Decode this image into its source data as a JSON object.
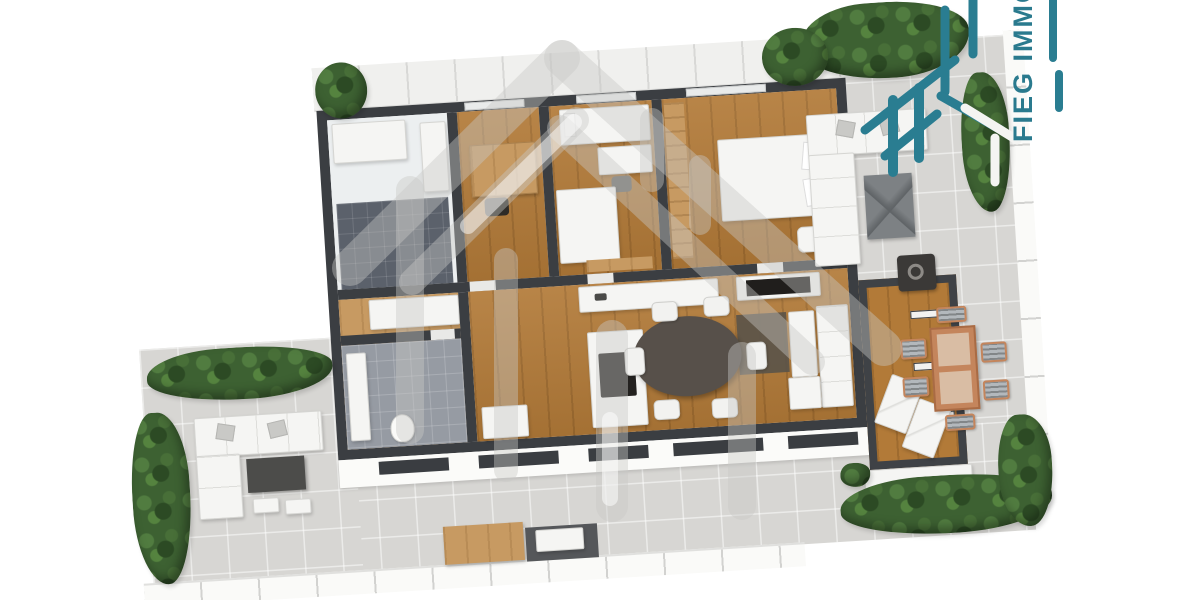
{
  "scene": {
    "type": "3d-rendered-floor-plan",
    "description": "Top-down 3D rendering of an apartment with wrap-around roof terrace"
  },
  "brand": {
    "text": "FIEG IMMOB",
    "color": "#2a7a8e",
    "logo_icon": "dashed-house-logo-icon",
    "watermark_icon": "dashed-house-watermark-icon"
  },
  "palette": {
    "background": "#ffffff",
    "wall": "#3b3e42",
    "terrace_tile": "#d7d6d3",
    "wood_floor": "#b27a38",
    "wood_light": "#c79a62",
    "bath_tile_dark": "#5b616b",
    "bath_tile_light": "#969ba3",
    "furniture_white": "#f5f5f3",
    "dining_table_dark": "#57504a",
    "hedge_green": "#3d6132",
    "outdoor_wood": "#c4855c",
    "watermark_gray": "#c7c7c5"
  },
  "areas": {
    "indoor": [
      "bathroom-1",
      "home-office",
      "kids-bedroom",
      "master-bedroom",
      "hallway",
      "bathroom-2",
      "open-kitchen-living-dining",
      "conservatory"
    ],
    "outdoor": [
      "left-terrace-lounge",
      "right-terrace-lounge",
      "outdoor-dining-terrace",
      "bottom-terrace",
      "planter-hedges"
    ]
  }
}
